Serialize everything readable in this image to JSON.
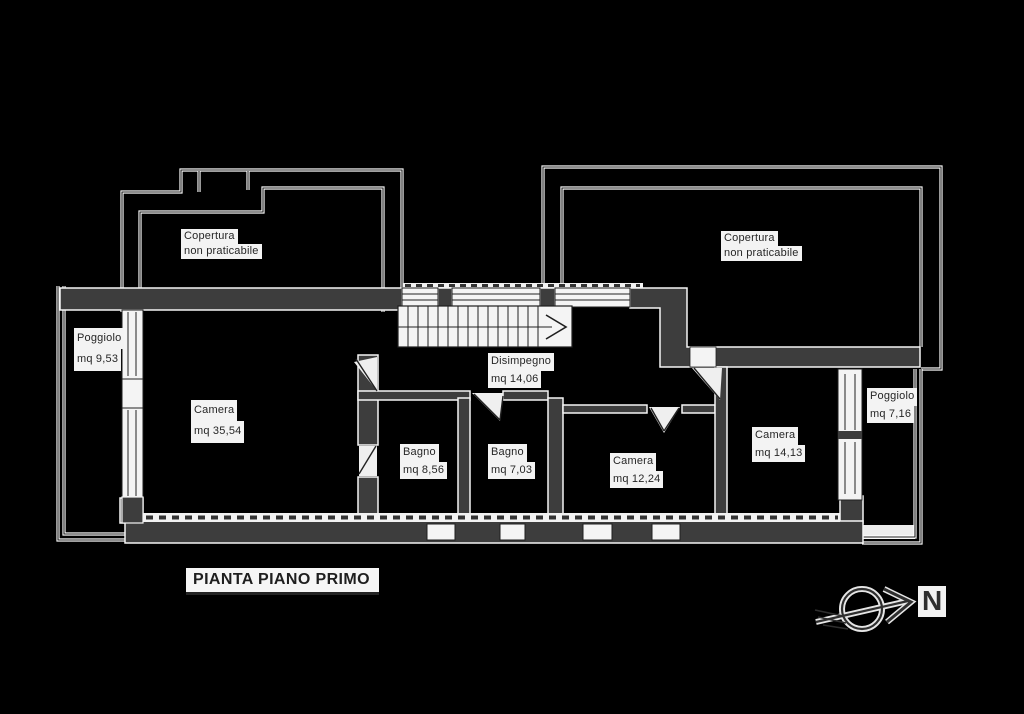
{
  "title": "PIANTA PIANO PRIMO",
  "compass": {
    "north_label": "N"
  },
  "colors": {
    "background": "#000000",
    "wall_fill": "#3d3d3d",
    "line_dark": "#1c1c1c",
    "line_halo": "#ffffff",
    "label_bg": "#f3f3f3",
    "label_text": "#262626"
  },
  "rooms": {
    "copertura_left": {
      "line1": "Copertura",
      "line2": "non praticabile"
    },
    "copertura_right": {
      "line1": "Copertura",
      "line2": "non praticabile"
    },
    "poggiolo_left": {
      "line1": "Poggiolo",
      "line2": "mq 9,53"
    },
    "camera_grande": {
      "line1": "Camera",
      "line2": "mq 35,54"
    },
    "disimpegno": {
      "line1": "Disimpegno",
      "line2": "mq 14,06"
    },
    "bagno_1": {
      "line1": "Bagno",
      "line2": "mq 8,56"
    },
    "bagno_2": {
      "line1": "Bagno",
      "line2": "mq 7,03"
    },
    "camera_media": {
      "line1": "Camera",
      "line2": "mq 12,24"
    },
    "camera_piccola": {
      "line1": "Camera",
      "line2": "mq 14,13"
    },
    "poggiolo_right": {
      "line1": "Poggiolo",
      "line2": "mq 7,16"
    }
  }
}
